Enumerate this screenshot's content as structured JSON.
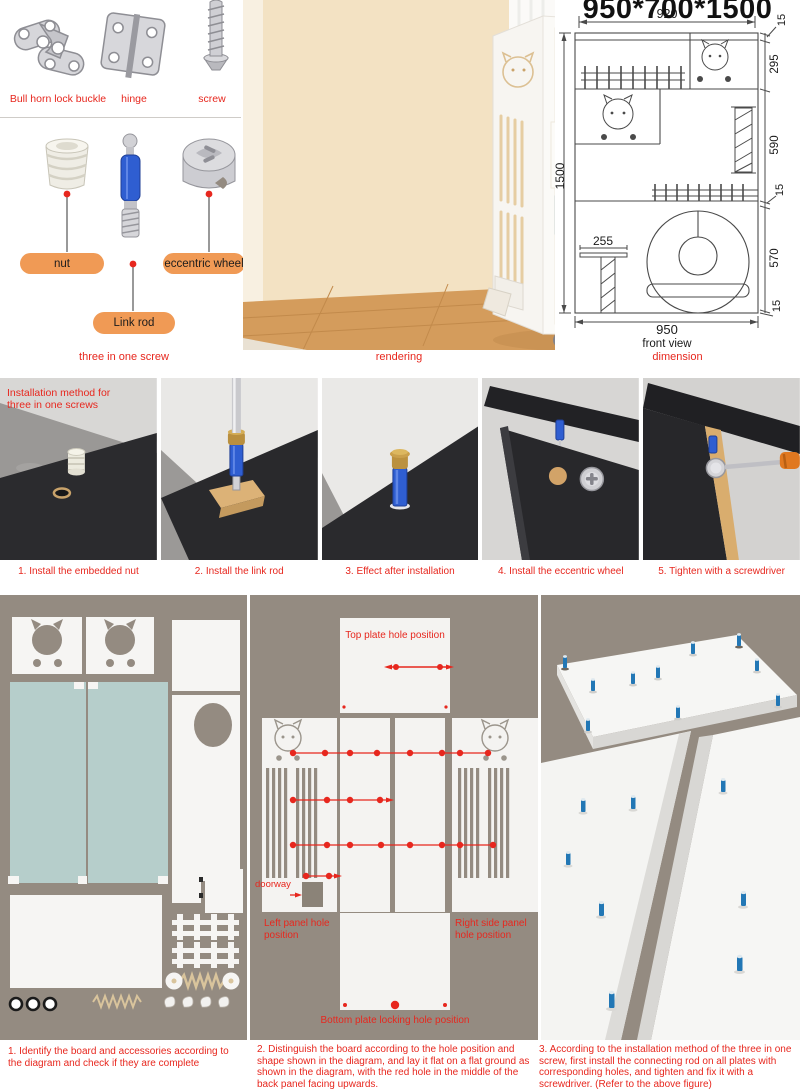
{
  "hardware": {
    "items": [
      {
        "label": "Bull horn lock buckle"
      },
      {
        "label": "hinge"
      },
      {
        "label": "screw"
      }
    ]
  },
  "three_in_one": {
    "nut": "nut",
    "link_rod": "Link rod",
    "eccentric_wheel": "eccentric wheel",
    "caption": "three in one screw"
  },
  "rendering": {
    "caption": "rendering"
  },
  "dimension": {
    "title": "950*700*1500",
    "caption": "dimension",
    "front_view": "front view",
    "width_top": "920",
    "width_bottom": "950",
    "height_left": "1500",
    "shelf_depth": "255",
    "right_stack": [
      "15",
      "295",
      "590",
      "15",
      "570",
      "15"
    ]
  },
  "steps": {
    "overlay": "Installation method for three in one screws",
    "items": [
      {
        "caption": "1. Install the embedded nut"
      },
      {
        "caption": "2. Install the link rod"
      },
      {
        "caption": "3. Effect after installation"
      },
      {
        "caption": "4. Install the eccentric wheel"
      },
      {
        "caption": "5. Tighten with a screwdriver"
      }
    ]
  },
  "assembly": {
    "top_plate_label": "Top plate hole position",
    "doorway_label": "doorway",
    "left_panel_label": "Left panel hole position",
    "right_panel_label": "Right side panel hole position",
    "bottom_plate_label": "Bottom plate locking hole position",
    "captions": [
      "1. Identify the board and accessories according to the diagram and check if they are complete",
      "2. Distinguish the board according to the hole position and shape shown in the diagram, and lay it flat on a flat ground as shown in the diagram, with the red hole in the middle of the back panel facing upwards.",
      "3. According to the installation method of the three in one screw, first install the connecting rod on all plates with corresponding holes, and tighten and fix it with a screwdriver. (Refer to the above figure)"
    ]
  },
  "colors": {
    "red": "#e7271e",
    "orange_pill": "#f09a55",
    "taupe_bg": "#948b81",
    "teal_board": "#b6cecb",
    "blue_rod": "#2f5ed1",
    "pin_blue": "#2277b5",
    "dark_board": "#2b2b2e"
  }
}
